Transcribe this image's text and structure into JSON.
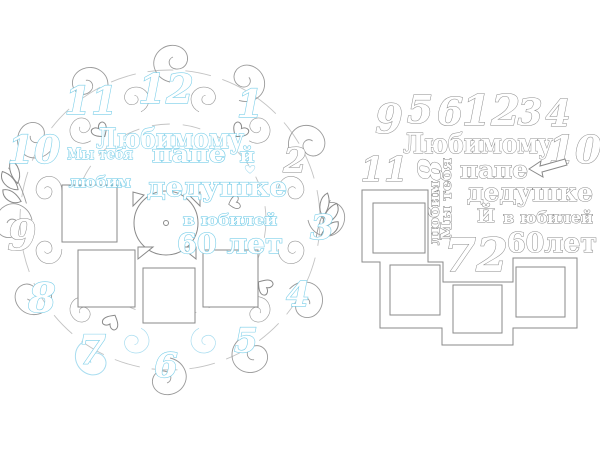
{
  "canvas": {
    "background": "#ffffff"
  },
  "colors": {
    "line_gray": "#8a8a8a",
    "accent_cyan": "#7ccfe9"
  },
  "assembled_clock": {
    "description": "assembled ornate clock photo frame",
    "numbers": {
      "n12": "12",
      "n1": "1",
      "n2": "2",
      "n3": "3",
      "n4": "4",
      "n5": "5",
      "n6": "6",
      "n7": "7",
      "n8": "8",
      "n9": "9",
      "n10": "10",
      "n11": "11"
    },
    "text": {
      "lyubimomu": "Любимому",
      "my_tebya": "Мы тебя",
      "pape": "папе",
      "i": "й",
      "lyubim": "любим",
      "dedushke": "дедушке",
      "v_yubiley": "в юбилей",
      "let60": "60 лет"
    }
  },
  "parts_sheet": {
    "description": "loose cut-out pieces",
    "numbers": {
      "n9": "9",
      "n5": "5",
      "n6": "6",
      "n12": "12",
      "n3": "3",
      "n4": "4",
      "n10": "10",
      "n11": "11",
      "n8": "8",
      "n72": "72"
    },
    "text": {
      "lyubimomu": "Любимому",
      "my_tebya": "Мы тебя",
      "lyubim": "любим",
      "pape": "папе",
      "dedushke": "дедушке",
      "i": "Й",
      "v_yubiley": "в юбилей",
      "let60": "60лет"
    }
  }
}
